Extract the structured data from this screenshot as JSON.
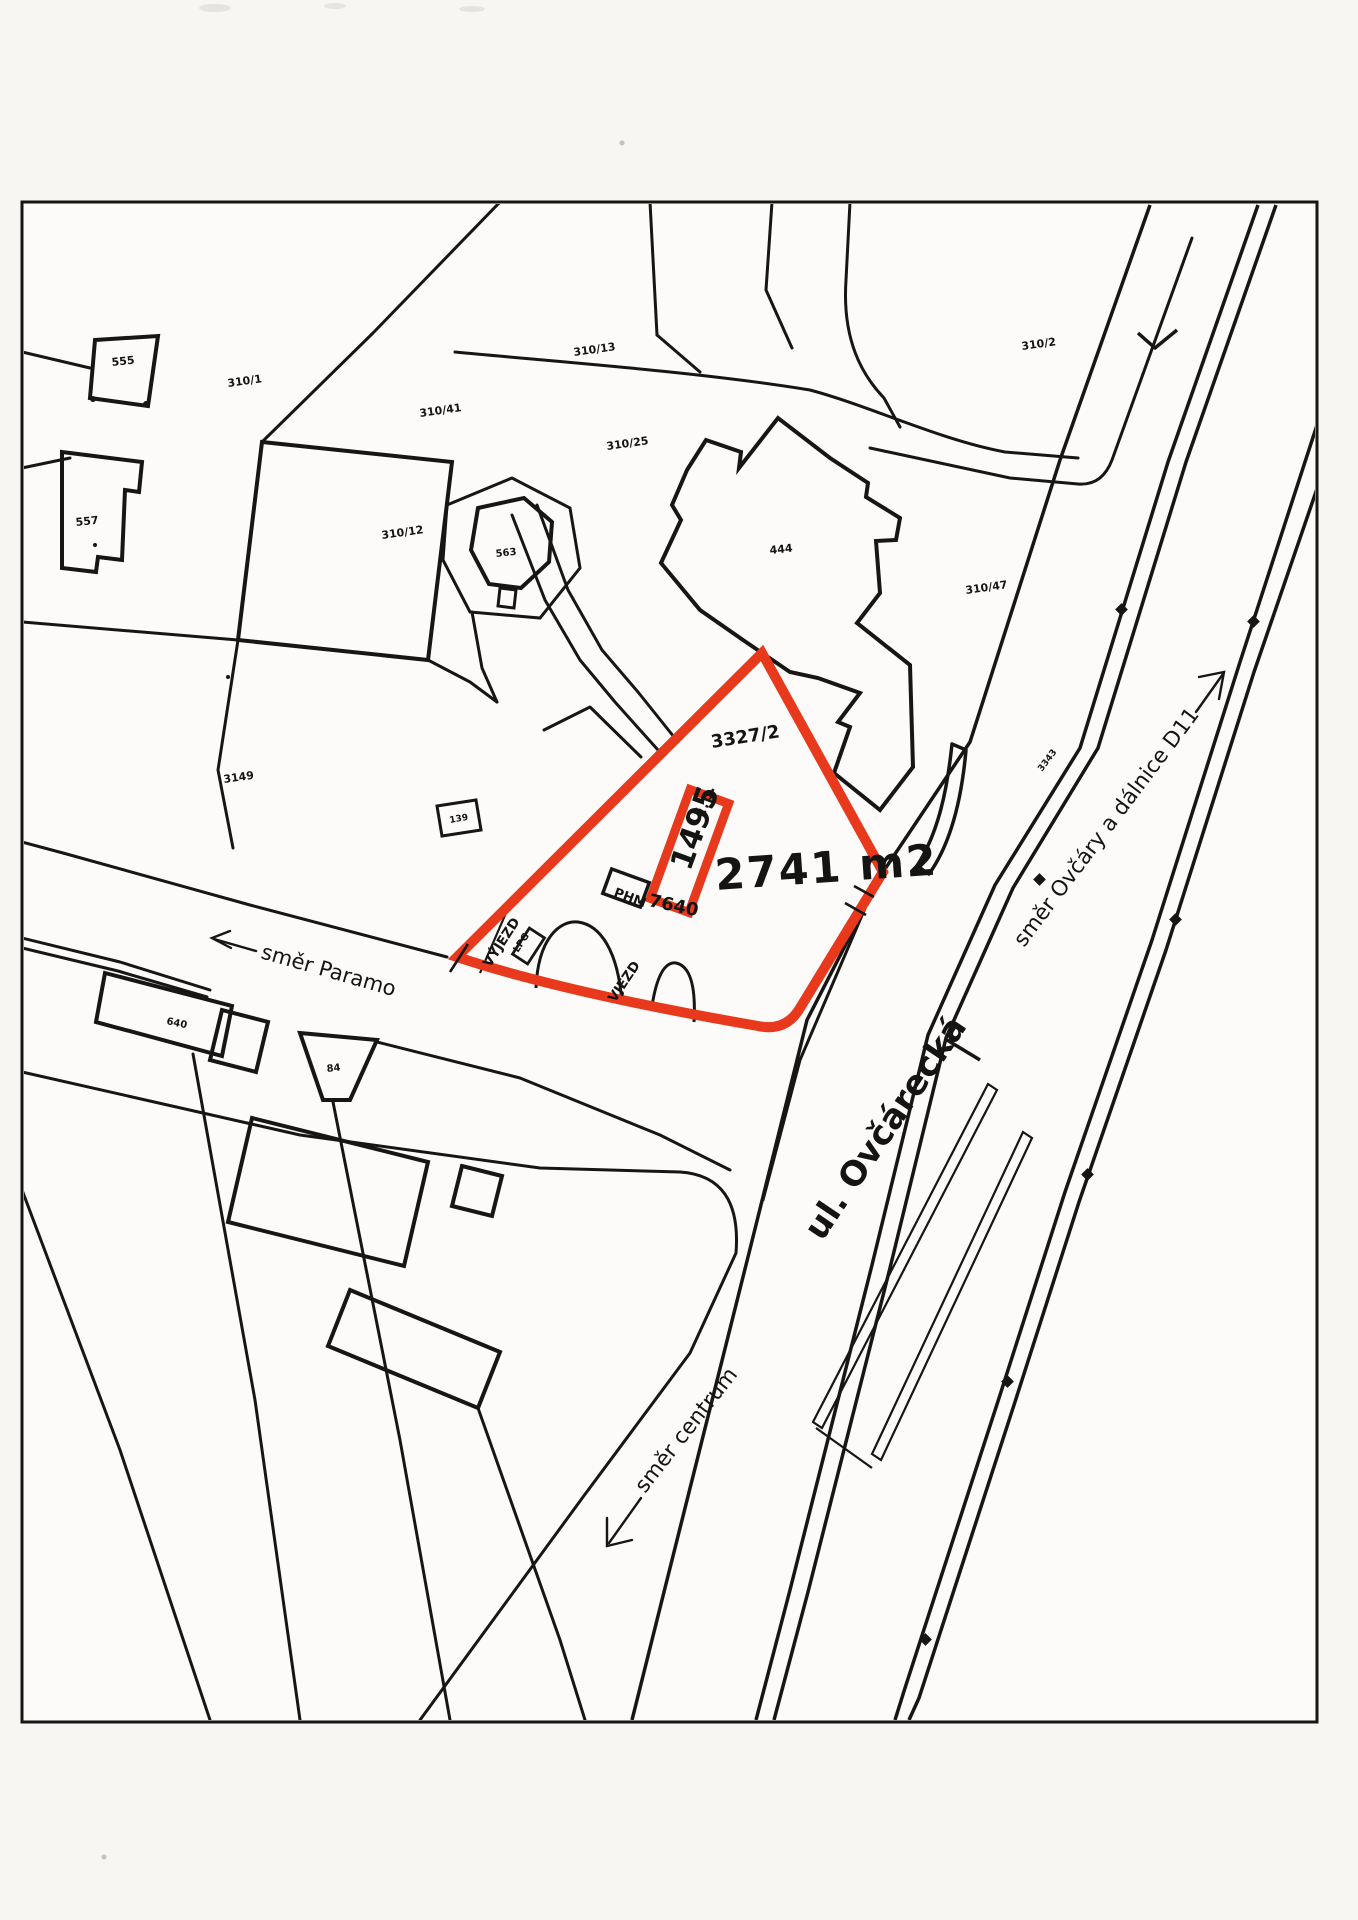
{
  "map": {
    "title_hint": "cadastral sketch",
    "colors": {
      "highlight": "#e8391d",
      "line": "#171615",
      "paper": "#f7f6f3",
      "map_bg": "#fcfbf9"
    },
    "highlight": {
      "area_label": "2741 m2",
      "parcel_number": "3327/2",
      "building_cp_label": "č.p.",
      "building_cp_number": "1495",
      "building_code": "7640",
      "phm_label": "PHM",
      "lpg_label": "LPG",
      "exit_label": "VÝJEZD",
      "entry_label": "VJEZD"
    },
    "streets": {
      "ovcarecka": "ul. Ovčárecká",
      "paramo": "směr Paramo",
      "centrum": "směr centrum",
      "d11": "směr Ovčáry a dálnice D11"
    },
    "parcels": [
      {
        "number": "555"
      },
      {
        "number": "310/1"
      },
      {
        "number": "310/41"
      },
      {
        "number": "557"
      },
      {
        "number": "310/13"
      },
      {
        "number": "310/25"
      },
      {
        "number": "563"
      },
      {
        "number": "310/12"
      },
      {
        "number": "444"
      },
      {
        "number": "310/2"
      },
      {
        "number": "310/47"
      },
      {
        "number": "3149"
      },
      {
        "number": "139"
      },
      {
        "number": "640"
      },
      {
        "number": "84"
      },
      {
        "number": "3343"
      }
    ]
  }
}
